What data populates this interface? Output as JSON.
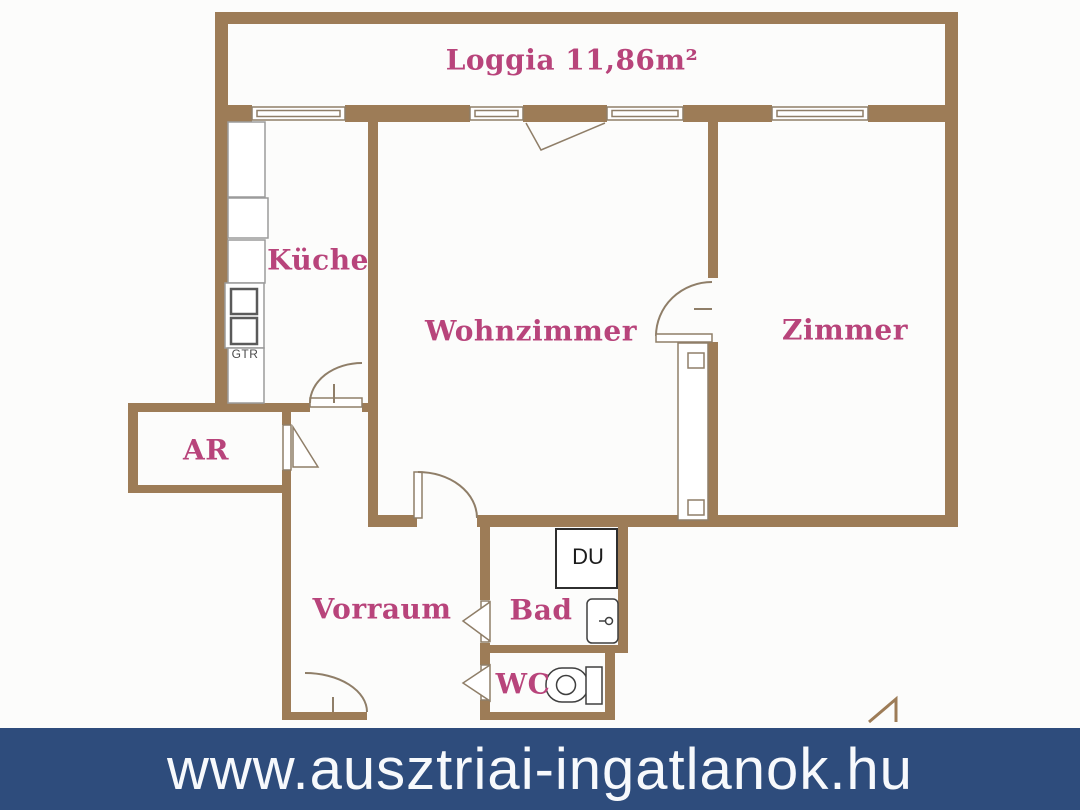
{
  "floor_plan": {
    "rooms": {
      "loggia": {
        "label": "Loggia 11,86m²"
      },
      "kueche": {
        "label": "Küche"
      },
      "wohnzimmer": {
        "label": "Wohnzimmer"
      },
      "zimmer": {
        "label": "Zimmer"
      },
      "ar": {
        "label": "AR"
      },
      "vorraum": {
        "label": "Vorraum"
      },
      "bad": {
        "label": "Bad"
      },
      "wc": {
        "label": "WC"
      }
    },
    "fixtures": {
      "shower_label": "DU",
      "boiler_label": "GTR"
    },
    "colors": {
      "wall": "#9d7c57",
      "line": "#8f7e68",
      "counter_line": "#9b9b9b",
      "fixture_line": "#3f3f3f",
      "shower_border": "#2e2e2e",
      "room_label": "#b8447b"
    }
  },
  "footer": {
    "website": "www.ausztriai-ingatlanok.hu",
    "background": "#2e4c7c",
    "text_color": "#f7f9fc"
  }
}
